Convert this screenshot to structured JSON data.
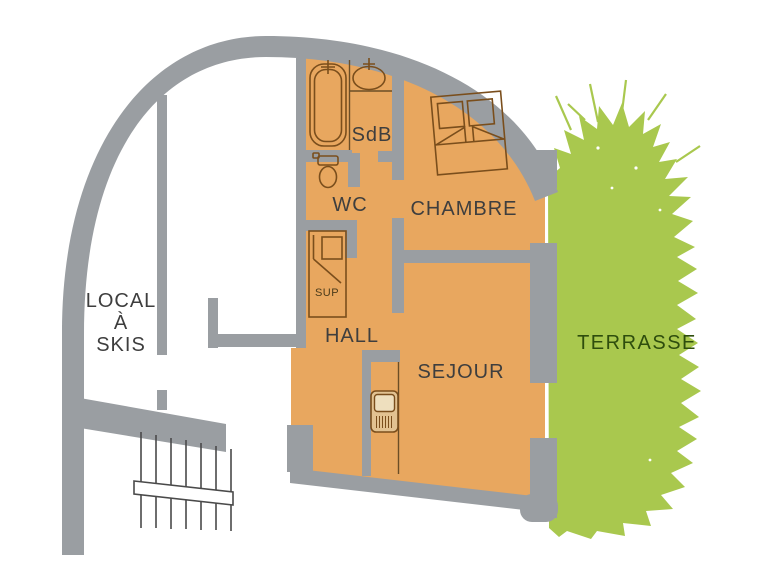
{
  "labels": {
    "local_a_skis": {
      "lines": [
        "LOCAL",
        "À",
        "SKIS"
      ]
    },
    "sdb": "SdB",
    "wc": "WC",
    "chambre": "CHAMBRE",
    "sup": "SUP",
    "hall": "HALL",
    "sejour": "SEJOUR",
    "terrasse": "TERRASSE"
  },
  "colors": {
    "background": "#ffffff",
    "wall": "#9a9ea2",
    "floor": "#e8a75f",
    "terrace": "#a9c84e",
    "fixture_outline": "#7a4e1c",
    "label_text": "#3e3e3e",
    "terrace_label_text": "#2e4d0d"
  },
  "icons": [
    "bathtub-icon",
    "sink-icon",
    "toilet-icon",
    "double-bed-icon",
    "wardrobe-icon",
    "stove-icon",
    "stairs-icon",
    "handrail-icon",
    "foliage-icon"
  ]
}
